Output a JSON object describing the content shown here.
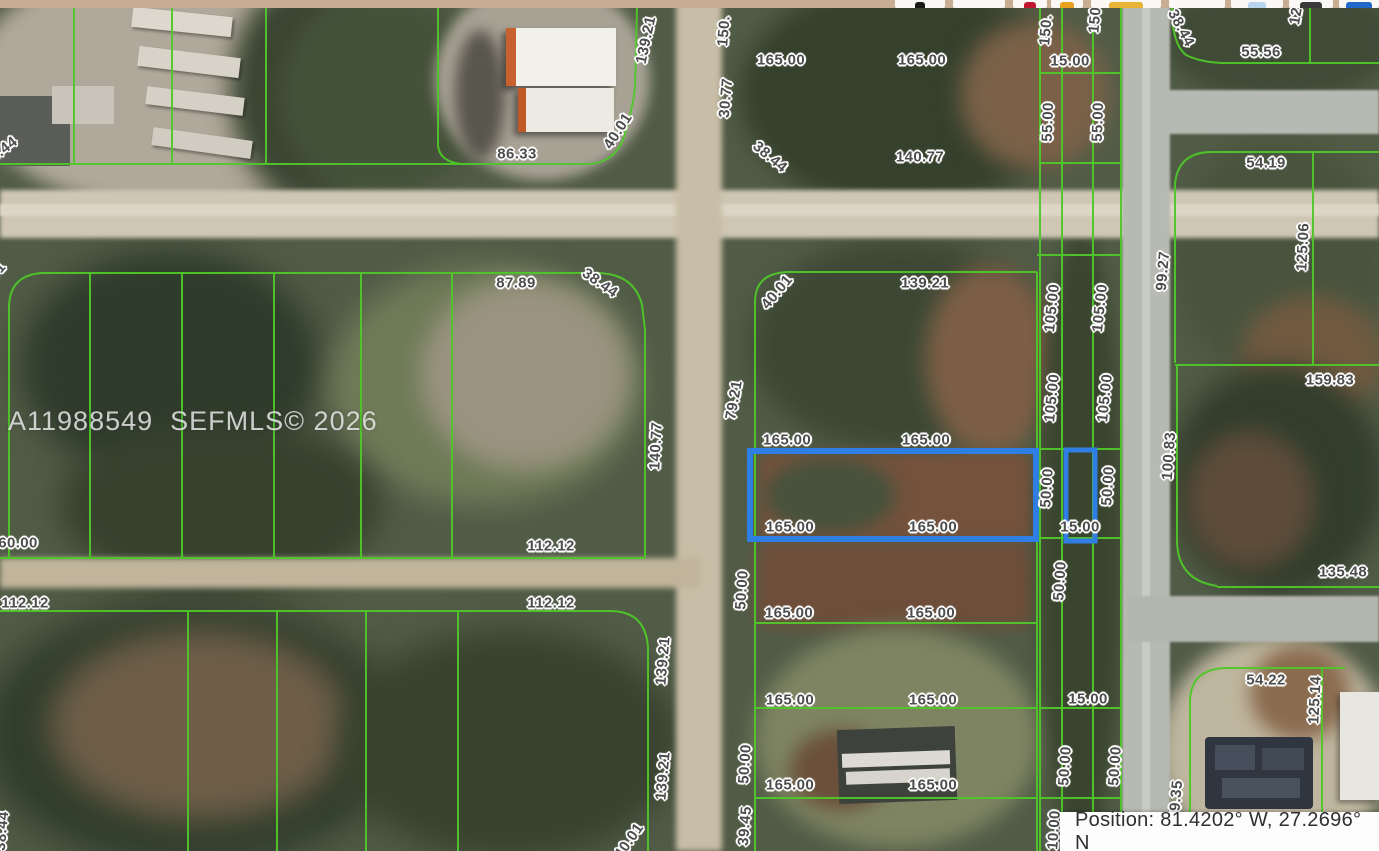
{
  "colors": {
    "toolbar_bg": "#c9ad92",
    "parcel_line": "#4fc728",
    "highlight_parcel": "#2f7ee3",
    "ground": "#515c47"
  },
  "toolbar": {
    "buttons": [
      {
        "x": 895,
        "w": 50,
        "icon": "location-marker-icon",
        "color": "#1a1a1a",
        "iw": 10
      },
      {
        "x": 953,
        "w": 52,
        "icon": "",
        "color": "",
        "iw": 0
      },
      {
        "x": 1013,
        "w": 34,
        "icon": "map-pin-icon",
        "color": "#c01830",
        "iw": 12
      },
      {
        "x": 1051,
        "w": 32,
        "icon": "ruler-icon",
        "color": "#e8a020",
        "iw": 14
      },
      {
        "x": 1091,
        "w": 70,
        "icon": "key-icon",
        "color": "#e8b438",
        "iw": 34
      },
      {
        "x": 1169,
        "w": 56,
        "icon": "",
        "color": "",
        "iw": 0
      },
      {
        "x": 1231,
        "w": 52,
        "icon": "panel-icon",
        "color": "#b8d4ec",
        "iw": 18
      },
      {
        "x": 1289,
        "w": 44,
        "icon": "menu-icon",
        "color": "#3a3a3a",
        "iw": 22
      },
      {
        "x": 1339,
        "w": 40,
        "icon": "globe-icon",
        "color": "#2268c8",
        "iw": 26
      }
    ]
  },
  "map": {
    "watermark": "A11988549  SEFMLS© 2026",
    "position_bar": {
      "text": "Position: 81.4202° W, 27.2696° N"
    },
    "labels": [
      {
        "t": "139.21",
        "x": 646,
        "y": 40,
        "r": -78
      },
      {
        "t": "150.",
        "x": 724,
        "y": 31,
        "r": -85
      },
      {
        "t": "165.00",
        "x": 781,
        "y": 60,
        "r": 0
      },
      {
        "t": "165.00",
        "x": 922,
        "y": 60,
        "r": 0
      },
      {
        "t": "150.",
        "x": 1046,
        "y": 30,
        "r": -85
      },
      {
        "t": "150",
        "x": 1095,
        "y": 20,
        "r": -85
      },
      {
        "t": "15.00",
        "x": 1070,
        "y": 61,
        "r": 0
      },
      {
        "t": "38.44",
        "x": 1181,
        "y": 28,
        "r": 62
      },
      {
        "t": "12",
        "x": 1296,
        "y": 16,
        "r": -80
      },
      {
        "t": "55.56",
        "x": 1261,
        "y": 52,
        "r": 0
      },
      {
        "t": "30.77",
        "x": 726,
        "y": 98,
        "r": -85
      },
      {
        "t": "40.01",
        "x": 618,
        "y": 131,
        "r": -57
      },
      {
        "t": "86.33",
        "x": 517,
        "y": 154,
        "r": 0
      },
      {
        "t": "38.44",
        "x": 0,
        "y": 152,
        "r": -38
      },
      {
        "t": "38.44",
        "x": 770,
        "y": 157,
        "r": 40
      },
      {
        "t": "140.77",
        "x": 920,
        "y": 157,
        "r": 0
      },
      {
        "t": "55.00",
        "x": 1048,
        "y": 122,
        "r": -88
      },
      {
        "t": "55.00",
        "x": 1098,
        "y": 122,
        "r": -88
      },
      {
        "t": "54.19",
        "x": 1266,
        "y": 163,
        "r": 0
      },
      {
        "t": "40.01",
        "x": -10,
        "y": 279,
        "r": -48
      },
      {
        "t": "87.89",
        "x": 516,
        "y": 283,
        "r": 0
      },
      {
        "t": "38.44",
        "x": 600,
        "y": 283,
        "r": 35
      },
      {
        "t": "40.01",
        "x": 777,
        "y": 292,
        "r": -50
      },
      {
        "t": "139.21",
        "x": 925,
        "y": 283,
        "r": 0
      },
      {
        "t": "99.27",
        "x": 1163,
        "y": 271,
        "r": -85
      },
      {
        "t": "125.06",
        "x": 1303,
        "y": 247,
        "r": -87
      },
      {
        "t": "105.00",
        "x": 1052,
        "y": 308,
        "r": -84
      },
      {
        "t": "105.00",
        "x": 1100,
        "y": 308,
        "r": -84
      },
      {
        "t": "159.83",
        "x": 1330,
        "y": 380,
        "r": 0
      },
      {
        "t": "79.21",
        "x": 734,
        "y": 400,
        "r": -80
      },
      {
        "t": "140.77",
        "x": 656,
        "y": 446,
        "r": -87
      },
      {
        "t": "165.00",
        "x": 787,
        "y": 440,
        "r": 0
      },
      {
        "t": "165.00",
        "x": 926,
        "y": 440,
        "r": 0
      },
      {
        "t": "105.00",
        "x": 1052,
        "y": 398,
        "r": -84
      },
      {
        "t": "105.00",
        "x": 1105,
        "y": 398,
        "r": -84
      },
      {
        "t": "100.83",
        "x": 1169,
        "y": 456,
        "r": -86
      },
      {
        "t": "50.00",
        "x": 1047,
        "y": 488,
        "r": -86
      },
      {
        "t": "50.00",
        "x": 1108,
        "y": 486,
        "r": -86
      },
      {
        "t": "165.00",
        "x": 790,
        "y": 527,
        "r": 0
      },
      {
        "t": "165.00",
        "x": 933,
        "y": 527,
        "r": 0
      },
      {
        "t": "15.00",
        "x": 1080,
        "y": 527,
        "r": 0
      },
      {
        "t": "60.00",
        "x": 18,
        "y": 543,
        "r": 0
      },
      {
        "t": "112.12",
        "x": 551,
        "y": 546,
        "r": 0
      },
      {
        "t": "112.12",
        "x": 25,
        "y": 603,
        "r": 0
      },
      {
        "t": "112.12",
        "x": 551,
        "y": 603,
        "r": 0
      },
      {
        "t": "135.48",
        "x": 1343,
        "y": 572,
        "r": 0
      },
      {
        "t": "50.00",
        "x": 742,
        "y": 590,
        "r": -86
      },
      {
        "t": "50.00",
        "x": 1060,
        "y": 581,
        "r": -86
      },
      {
        "t": "165.00",
        "x": 789,
        "y": 613,
        "r": 0
      },
      {
        "t": "165.00",
        "x": 931,
        "y": 613,
        "r": 0
      },
      {
        "t": "139.21",
        "x": 663,
        "y": 661,
        "r": -85
      },
      {
        "t": "165.00",
        "x": 790,
        "y": 700,
        "r": 0
      },
      {
        "t": "165.00",
        "x": 933,
        "y": 700,
        "r": 0
      },
      {
        "t": "15.00",
        "x": 1088,
        "y": 699,
        "r": 0
      },
      {
        "t": "54.22",
        "x": 1266,
        "y": 680,
        "r": 0
      },
      {
        "t": "125.14",
        "x": 1315,
        "y": 700,
        "r": -87
      },
      {
        "t": "50.00",
        "x": 745,
        "y": 764,
        "r": -86
      },
      {
        "t": "139.21",
        "x": 663,
        "y": 776,
        "r": -85
      },
      {
        "t": "165.00",
        "x": 790,
        "y": 785,
        "r": 0
      },
      {
        "t": "165.00",
        "x": 933,
        "y": 785,
        "r": 0
      },
      {
        "t": "50.00",
        "x": 1065,
        "y": 766,
        "r": -86
      },
      {
        "t": "50.00",
        "x": 1115,
        "y": 766,
        "r": -86
      },
      {
        "t": "99.35",
        "x": 1176,
        "y": 800,
        "r": -85
      },
      {
        "t": "39.45",
        "x": 745,
        "y": 826,
        "r": -85
      },
      {
        "t": "40.01",
        "x": 629,
        "y": 841,
        "r": -55
      },
      {
        "t": "10.00",
        "x": 1054,
        "y": 830,
        "r": -86
      },
      {
        "t": "38.44",
        "x": 2,
        "y": 831,
        "r": -85
      }
    ]
  }
}
